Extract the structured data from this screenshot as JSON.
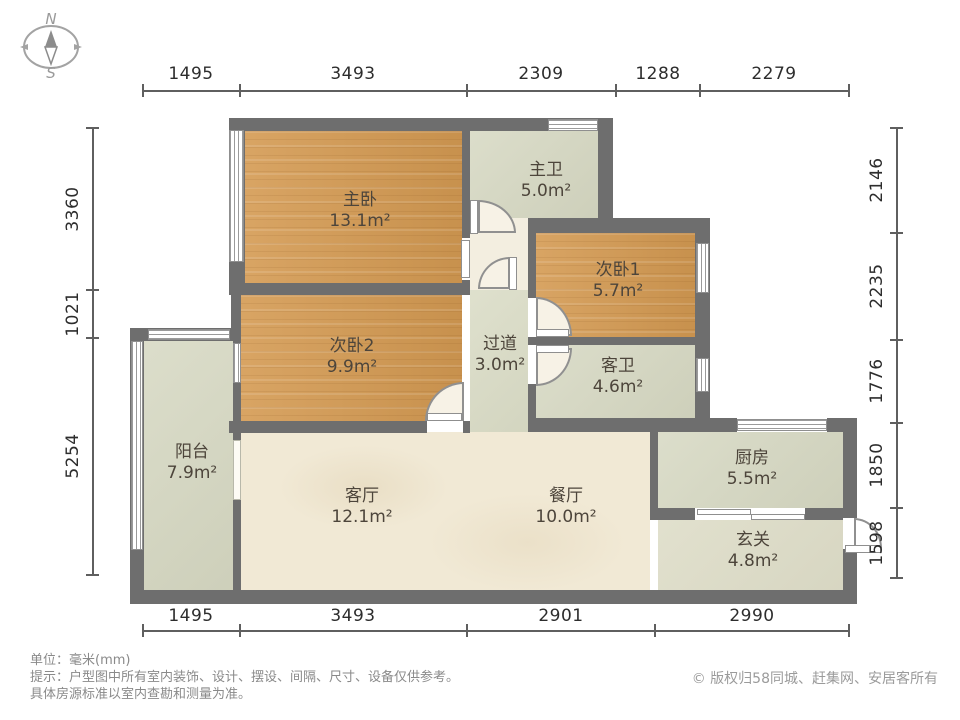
{
  "compass": {
    "north": "N",
    "south": "S"
  },
  "dimensions": {
    "top": [
      "1495",
      "3493",
      "2309",
      "1288",
      "2279"
    ],
    "bottom": [
      "1495",
      "3493",
      "2901",
      "2990"
    ],
    "left": [
      "3360",
      "1021",
      "5254"
    ],
    "right": [
      "2146",
      "2235",
      "1776",
      "1850",
      "1598"
    ]
  },
  "rooms": {
    "master_bedroom": {
      "name": "主卧",
      "area": "13.1m²"
    },
    "master_bath": {
      "name": "主卫",
      "area": "5.0m²"
    },
    "bedroom1": {
      "name": "次卧1",
      "area": "5.7m²"
    },
    "bedroom2": {
      "name": "次卧2",
      "area": "9.9m²"
    },
    "hallway": {
      "name": "过道",
      "area": "3.0m²"
    },
    "guest_bath": {
      "name": "客卫",
      "area": "4.6m²"
    },
    "balcony": {
      "name": "阳台",
      "area": "7.9m²"
    },
    "living": {
      "name": "客厅",
      "area": "12.1m²"
    },
    "dining": {
      "name": "餐厅",
      "area": "10.0m²"
    },
    "kitchen": {
      "name": "厨房",
      "area": "5.5m²"
    },
    "entry": {
      "name": "玄关",
      "area": "4.8m²"
    }
  },
  "footer": {
    "unit_line": "单位：毫米(mm)",
    "tip_line1": "提示：户型图中所有室内装饰、设计、摆设、间隔、尺寸、设备仅供参考。",
    "tip_line2": "具体房源标准以室内查勘和测量为准。",
    "copyright_icon": "©",
    "copyright": "版权归58同城、赶集网、安居客所有"
  },
  "colors": {
    "wall": "#6e6e6e",
    "wood_floor": "#d49a52",
    "tile_floor": "#d6d8c2",
    "living_floor": "#f1e9d5",
    "dim_text": "#2d2d2d",
    "footer_text": "#8a8a8a"
  }
}
